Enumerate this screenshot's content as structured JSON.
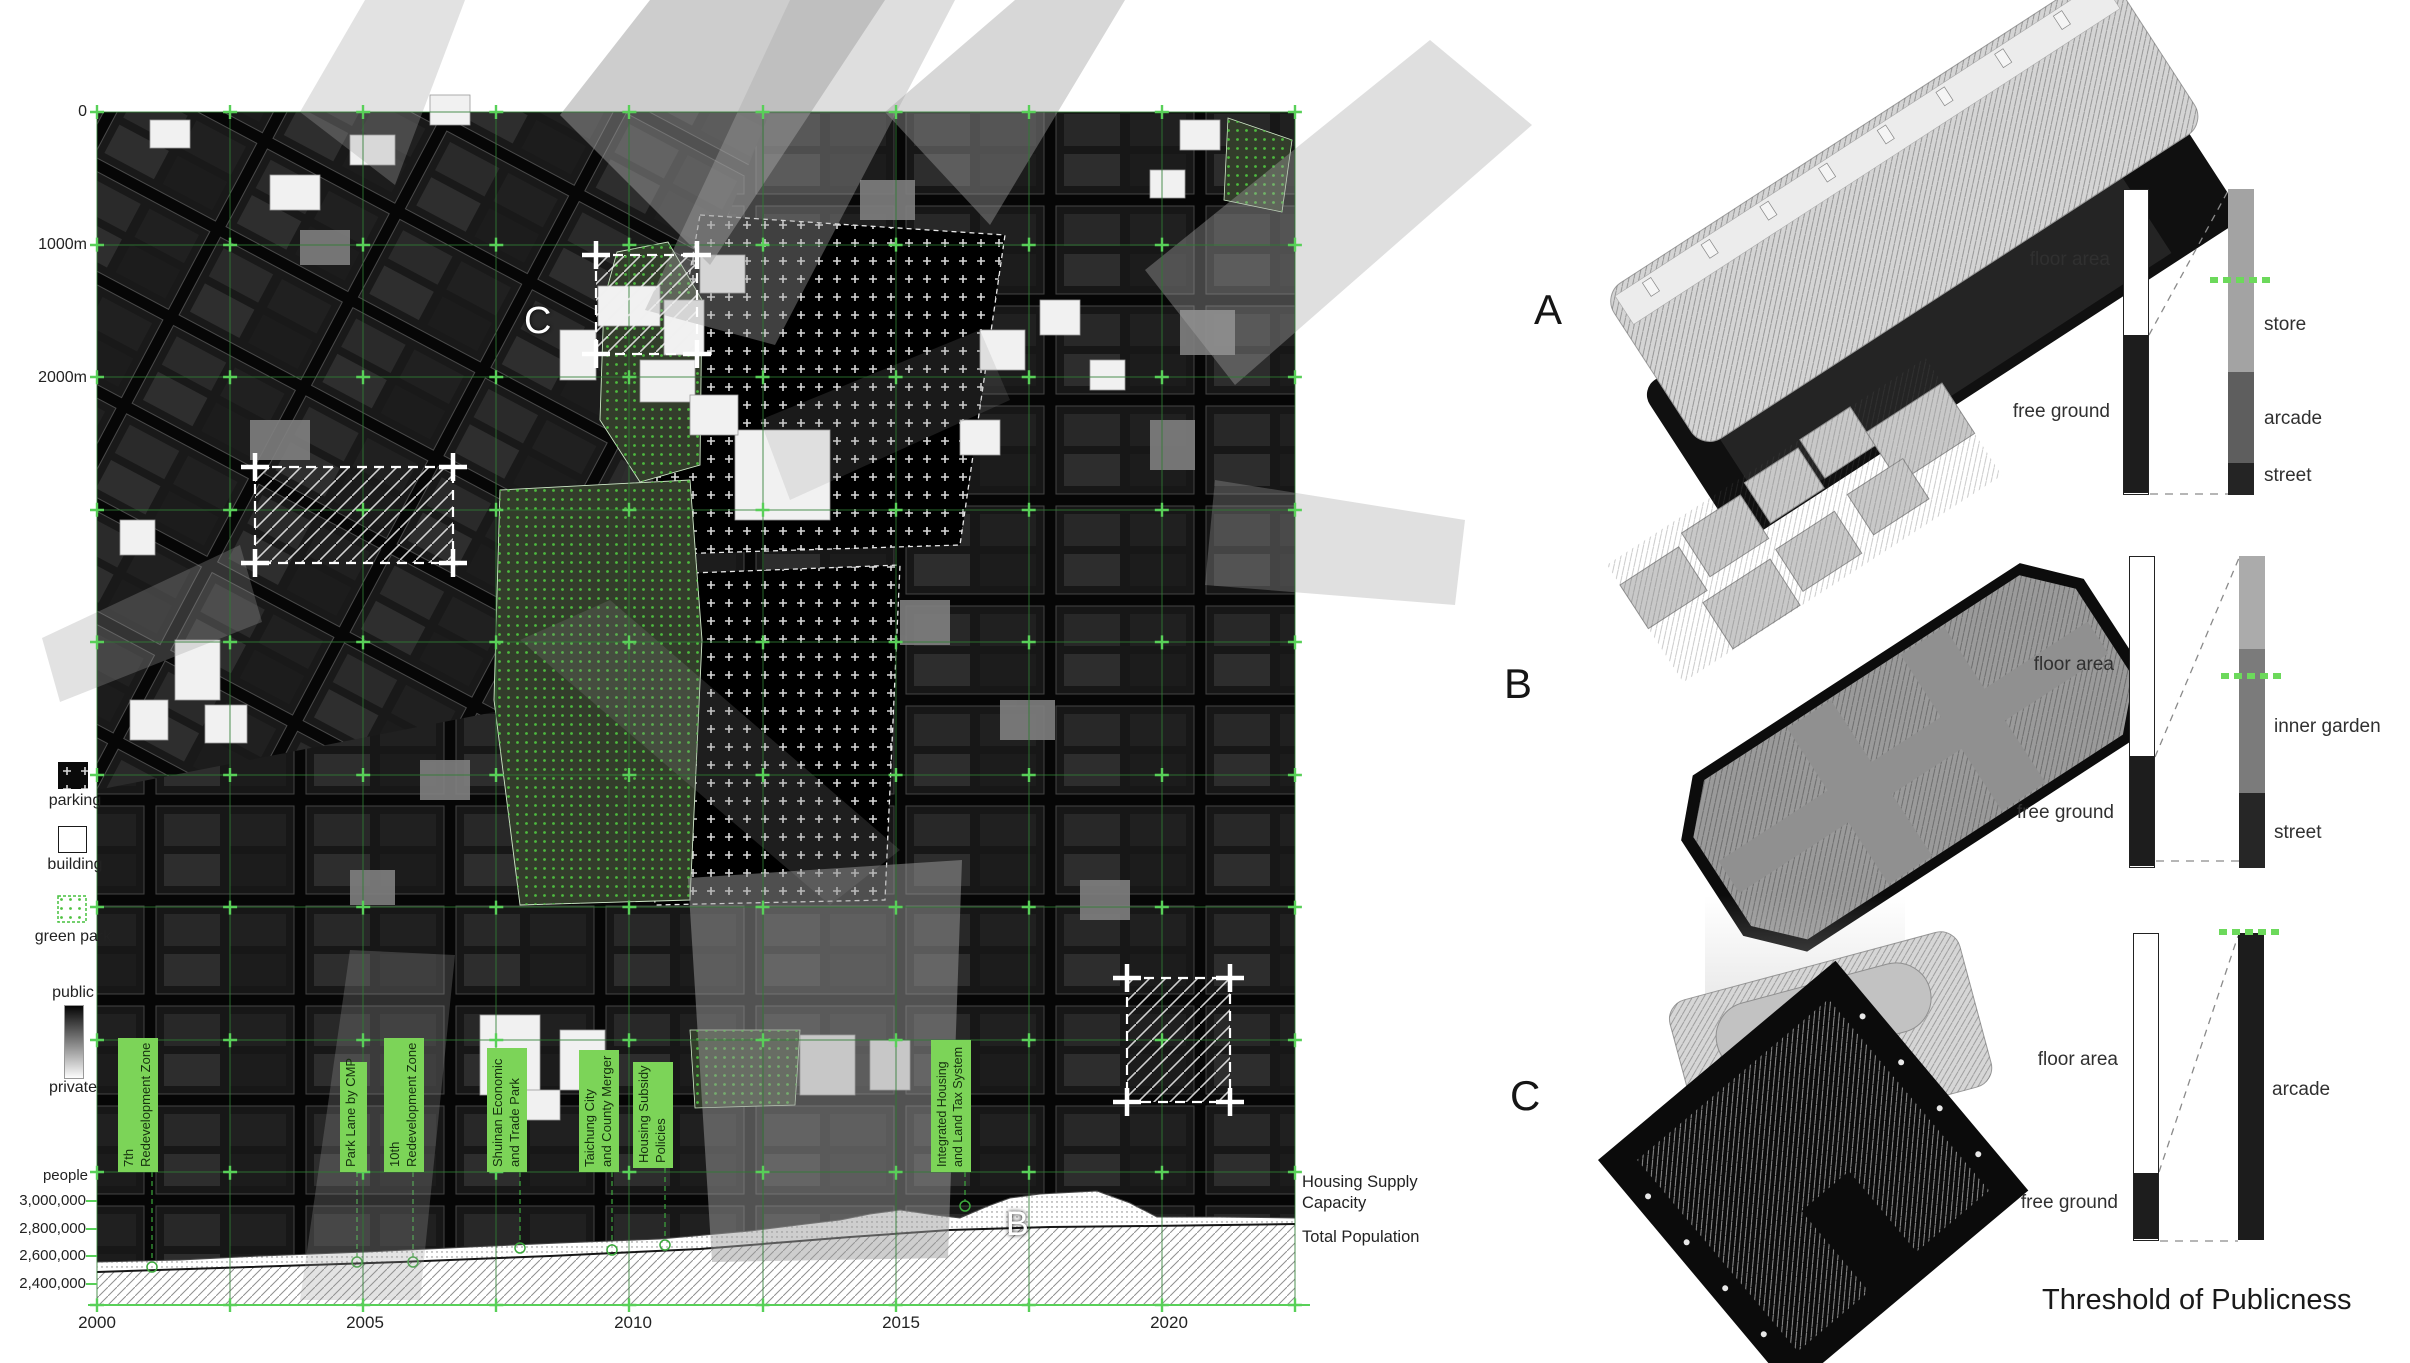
{
  "colors": {
    "policy_green": "#7cd458",
    "grid_green": "#2f7d33",
    "bright_green": "#58d058",
    "dash_green": "#6cd95b",
    "map_bg": "#050505",
    "park_dot_green": "#4ec13f"
  },
  "map": {
    "scale_labels": [
      "0",
      "1000m",
      "2000m"
    ],
    "legend": {
      "parking": "parking",
      "building": "building",
      "green_park": "green park",
      "public": "public",
      "private": "private"
    },
    "letters": {
      "c": "C",
      "b": "B"
    }
  },
  "timeline": {
    "unit": "people",
    "yticks": [
      "3,000,000",
      "2,800,000",
      "2,600,000",
      "2,400,000"
    ],
    "years": [
      "2000",
      "2005",
      "2010",
      "2015",
      "2020"
    ],
    "right_labels": {
      "housing": "Housing Supply Capacity",
      "population": "Total Population"
    },
    "policies": [
      {
        "lines": [
          "7th",
          "Redevelopment Zone"
        ]
      },
      {
        "lines": [
          "Park Lane by CMP"
        ]
      },
      {
        "lines": [
          "10th",
          "Redevelopment Zone"
        ]
      },
      {
        "lines": [
          "Shuinan Economic",
          "and Trade Park"
        ]
      },
      {
        "lines": [
          "Taichung City",
          "and County Merger"
        ]
      },
      {
        "lines": [
          "Housing Subsidy",
          "Policies"
        ]
      },
      {
        "lines": [
          "Integrated Housing",
          "and Land Tax System"
        ]
      }
    ]
  },
  "svg_points": {
    "housing_area": "97,1262 180,1260 260,1256 366,1252 470,1247 560,1243 660,1239 750,1231 806,1224 840,1220 870,1214 900,1210 935,1215 960,1218 988,1206 1010,1198 1040,1194 1097,1191 1130,1203 1157,1217 1220,1217 1295,1218 1295,1305 97,1305",
    "housing_top": "97,1262 180,1260 260,1256 366,1252 470,1247 560,1243 660,1239 750,1231 806,1224 840,1220 870,1214 900,1210 935,1215 960,1218 988,1206 1010,1198 1040,1194 1097,1191 1130,1203 1157,1217 1220,1217 1295,1218",
    "population_area": "97,1272 250,1267 400,1262 550,1256 700,1249 850,1237 950,1230 1050,1227 1150,1226 1295,1224 1295,1305 97,1305",
    "population_line": "97,1272 250,1267 400,1262 550,1256 700,1249 850,1237 950,1230 1050,1227 1150,1226 1295,1224"
  },
  "chart_data": {
    "type": "area",
    "title": "Population vs Housing Supply Capacity, Taichung 2000-2022",
    "x_years": [
      2000,
      2005,
      2010,
      2015,
      2019,
      2022
    ],
    "series": [
      {
        "name": "Housing Supply Capacity",
        "fill_style": "dotted",
        "values_people": [
          2560000,
          2630000,
          2680000,
          2940000,
          3080000,
          2880000
        ]
      },
      {
        "name": "Total Population",
        "fill_style": "hatched",
        "values_people": [
          2490000,
          2550000,
          2620000,
          2770000,
          2810000,
          2840000
        ]
      }
    ],
    "ylabel": "people",
    "yticks_values": [
      3000000,
      2800000,
      2600000,
      2400000
    ],
    "ylim": [
      2250000,
      3150000
    ],
    "xlim": [
      2000,
      2022.5
    ],
    "legend_position": "right",
    "events": [
      {
        "year": 2001.0,
        "label": "7th Redevelopment Zone"
      },
      {
        "year": 2004.9,
        "label": "Park Lane by CMP"
      },
      {
        "year": 2005.9,
        "label": "10th Redevelopment Zone"
      },
      {
        "year": 2007.9,
        "label": "Shuinan Economic and Trade Park"
      },
      {
        "year": 2009.6,
        "label": "Taichung City and County Merger"
      },
      {
        "year": 2010.6,
        "label": "Housing Subsidy Policies"
      },
      {
        "year": 2016.2,
        "label": "Integrated Housing and Land Tax System"
      }
    ]
  },
  "panel": {
    "title": "Threshold of Publicness",
    "rows": [
      {
        "letter": "A",
        "floor_label": "floor area",
        "free_label": "free ground",
        "seg_labels": [
          "store",
          "arcade",
          "street"
        ],
        "left_bar": [
          {
            "h": "145px",
            "color": "#ffffff"
          },
          {
            "h": "158px",
            "color": "#1d1d1d"
          }
        ],
        "right_bar": [
          {
            "h": "183px",
            "color": "#a3a3a3"
          },
          {
            "h": "91px",
            "color": "#5e5e5e"
          },
          {
            "h": "32px",
            "color": "#242424"
          }
        ],
        "threshold_ratio": 0.71
      },
      {
        "letter": "B",
        "floor_label": "floor area",
        "free_label": "free ground",
        "seg_labels": [
          "inner garden",
          "street"
        ],
        "left_bar": [
          {
            "h": "199px",
            "color": "#ffffff"
          },
          {
            "h": "110px",
            "color": "#1d1d1d"
          }
        ],
        "right_bar": [
          {
            "h": "93px",
            "color": "#ababab"
          },
          {
            "h": "144px",
            "color": "#7b7b7b"
          },
          {
            "h": "75px",
            "color": "#262626"
          }
        ],
        "threshold_ratio": 0.62
      },
      {
        "letter": "C",
        "floor_label": "floor area",
        "free_label": "free ground",
        "seg_labels": [
          "arcade"
        ],
        "left_bar": [
          {
            "h": "239px",
            "color": "#ffffff"
          },
          {
            "h": "66px",
            "color": "#1d1d1d"
          }
        ],
        "right_bar": [
          {
            "h": "307px",
            "color": "#1c1c1c"
          }
        ],
        "threshold_ratio": 1.0
      }
    ]
  }
}
